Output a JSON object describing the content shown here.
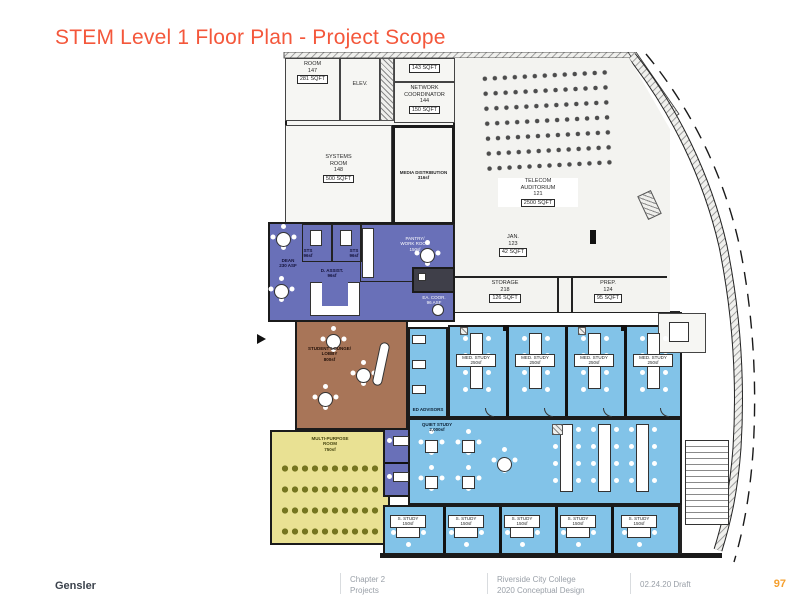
{
  "title": "STEM Level 1 Floor Plan - Project Scope",
  "footer": {
    "brand": "Gensler",
    "chapter_line1": "Chapter 2",
    "chapter_line2": "Projects",
    "client_line1": "Riverside City College",
    "client_line2": "2020 Conceptual Design",
    "date_draft": "02.24.20 Draft",
    "page_number": "97"
  },
  "colors": {
    "title_orange": "#F4573B",
    "page_number_orange": "#F5A02F",
    "admin_purple": "#6970B8",
    "lounge_brown": "#A87558",
    "multipurpose_yellow": "#E9E193",
    "study_blue": "#82C3E8"
  },
  "rooms": {
    "room147": {
      "l1": "ROOM",
      "l2": "147",
      "sq": "281 SQFT"
    },
    "elev": {
      "l1": "ELEV."
    },
    "room143": {
      "sq": "143 SQFT"
    },
    "network": {
      "l1": "NETWORK",
      "l2": "COORDINATOR",
      "l3": "144",
      "sq": "150 SQFT"
    },
    "systems": {
      "l1": "SYSTEMS",
      "l2": "ROOM",
      "l3": "148",
      "sq": "500 SQFT"
    },
    "media": {
      "l1": "MEDIA DISTRIBUTION",
      "l2": "316sf"
    },
    "auditorium": {
      "l1": "TELECOM",
      "l2": "AUDITORIUM",
      "l3": "121",
      "sq": "2500 SQFT"
    },
    "jan": {
      "l1": "JAN.",
      "l2": "123",
      "sq": "42 SQFT"
    },
    "storage": {
      "l1": "STORAGE",
      "l2": "218",
      "sq": "126 SQFT"
    },
    "prep": {
      "l1": "PREP.",
      "l2": "124",
      "sq": "95 SQFT"
    },
    "dean": {
      "l1": "DEAN",
      "l2": "230 ASF"
    },
    "sts_a": {
      "l1": "STS",
      "l2": "96sf"
    },
    "sts_b": {
      "l1": "STS",
      "l2": "96sf"
    },
    "dean_assist": {
      "l1": "D. ASSIST.",
      "l2": "96sf"
    },
    "pantry": {
      "l1": "PANTRY/",
      "l2": "WORK ROOM",
      "l3": "150sf"
    },
    "ea_coord": {
      "l1": "EA. COOR.",
      "l2": "96 ASF"
    },
    "lounge": {
      "l1": "STUDENT LOUNGE/",
      "l2": "LOBBY",
      "l3": "800sf"
    },
    "advisors": {
      "l1": "ED ADVISORS"
    },
    "multipurpose": {
      "l1": "MULTI-PURPOSE",
      "l2": "ROOM",
      "l3": "750sf"
    },
    "quiet": {
      "l1": "QUIET STUDY",
      "l2": "2,000sf"
    },
    "med_study": {
      "l1": "MED. STUDY",
      "l2": "250sf"
    },
    "s_study": {
      "l1": "S. STUDY",
      "l2": "150sf"
    }
  }
}
